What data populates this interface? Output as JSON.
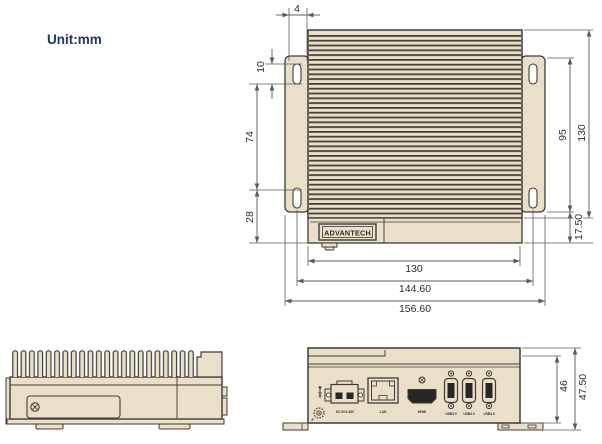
{
  "unit_label": "Unit:mm",
  "brand_logo": "ADVANTECH",
  "colors": {
    "body_fill": "#eadfc9",
    "outline": "#3f3c36",
    "dimension_line": "#5a5a63",
    "dimension_text": "#2d2d35",
    "title_text": "#1d3767",
    "port_opening": "#262626"
  },
  "top_view": {
    "vertical_dims": {
      "slot_offset": "4",
      "slot_length": "10",
      "slot_spacing": "74",
      "slot_to_edge": "28",
      "bracket_height": "95",
      "body_height": "130",
      "front_depth": "17.50"
    },
    "horizontal_dims": {
      "body_width": "130",
      "mounting_span": "144.60",
      "overall_width": "156.60"
    }
  },
  "front_view": {
    "height_dims": {
      "inner_height": "46",
      "overall_height": "47.50"
    },
    "port_labels": {
      "power": "DC IN 9-36V",
      "lan": "LAN",
      "hdmi": "HDMI",
      "usb1": "USB3.0",
      "usb2": "USB3.0",
      "usb3": "USB3.0"
    }
  }
}
